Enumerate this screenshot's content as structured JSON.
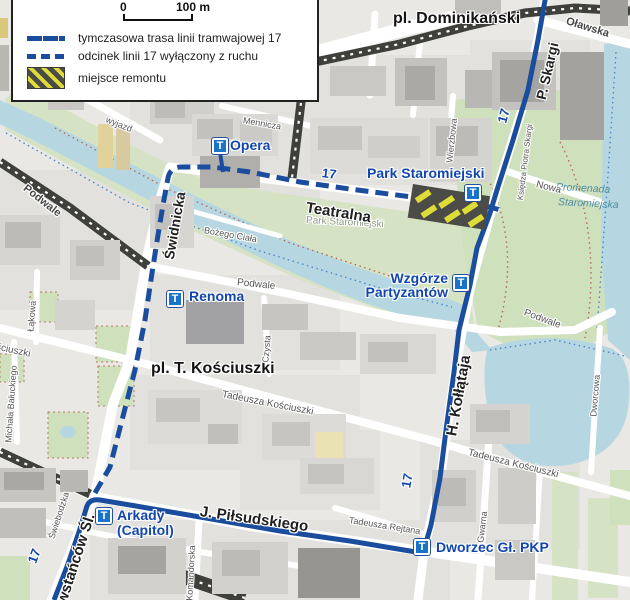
{
  "legend": {
    "scale_zero": "0",
    "scale_label": "100 m",
    "items": {
      "solid": "tymczasowa trasa linii tramwajowej 17",
      "dashed": "odcinek linii 17 wyłączony z ruchu",
      "hazard": "miejsce remontu"
    }
  },
  "route_number": "17",
  "stop_glyph": "T",
  "stops": {
    "opera": "Opera",
    "renoma": "Renoma",
    "park_staromiejski": "Park Staromiejski",
    "wzgorze_line1": "Wzgórze",
    "wzgorze_line2": "Partyzantów",
    "arkady_line1": "Arkady",
    "arkady_line2": "(Capitol)",
    "dworzec": "Dworzec Gł. PKP"
  },
  "places": {
    "dominikanski": "pl. Dominikański",
    "kosciuszki_square": "pl. T. Kościuszki",
    "park_staromiejski": "Park Staromiejski",
    "promenada_line1": "Promenada",
    "promenada_line2": "Staromiejska"
  },
  "streets": {
    "olawska": "Oławska",
    "p_skargi": "P. Skargi",
    "ksiedza_piotra_skargi": "Księdza Piotra Skargi",
    "swidnicka": "Świdnicka",
    "teatralna": "Teatralna",
    "mennicza": "Mennicza",
    "wierzbowa": "Wierzbowa",
    "bozego_ciala": "Bożego Ciała",
    "podwale_left": "Podwale",
    "podwale_center": "Podwale",
    "podwale_right": "Podwale",
    "czysta": "Czysta",
    "nowa": "Nowa",
    "wyjazd": "wyjazd",
    "kollataja": "H. Kołłątaja",
    "tadeusza_kosciuszki_w": "Tadeusza Kościuszki",
    "tadeusza_kosciuszki_e": "Tadeusza Kościuszki",
    "rejtana": "Tadeusza Rejtana",
    "pilsudskiego": "J. Piłsudskiego",
    "powstancow": "Powstańców Śl.",
    "komandorska": "Komandorska",
    "dworcowa": "Dworcowa",
    "lakowa": "Łąkowa",
    "baluckiego": "Michała Bałuckiego",
    "swiebodzka": "Świebodzka",
    "kosciuszki_frag": "Kościuszki",
    "gwarna": "Gwarna"
  },
  "colors": {
    "route_blue": "#1b4d9e",
    "label_blue": "#1246ac",
    "stop_blue": "#1973c8",
    "hazard_yellow": "#dedc38",
    "hazard_gray": "#4b4b47",
    "water": "#b6d7e2",
    "park": "#d5e3c4",
    "dark_road": "#3f3f3c"
  }
}
